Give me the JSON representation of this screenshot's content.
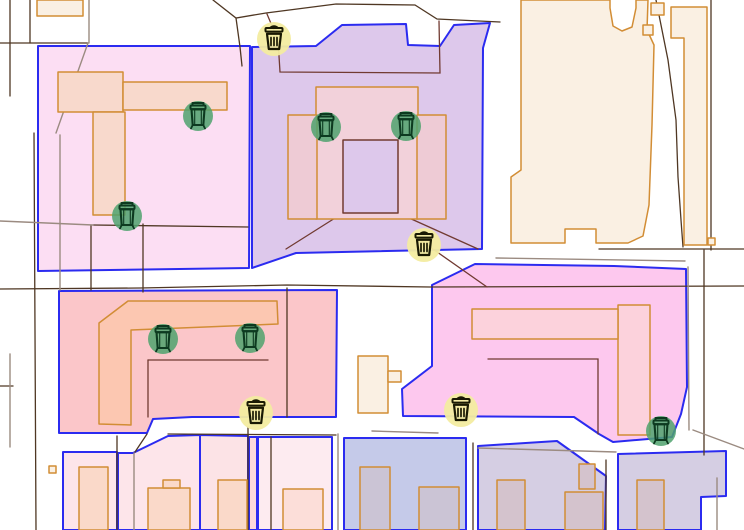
{
  "canvas": {
    "width": 744,
    "height": 530,
    "background": "#ffffff"
  },
  "palette": {
    "zone_border": "#2b2bf0",
    "building_stroke": "#d28d35",
    "line_dark": "#4f3723",
    "line_gray": "#9b8b81",
    "line_maroon": "#713a31",
    "marker_basket_bg": "#f3eca0",
    "marker_basket_glyph": "#191903",
    "marker_disposal_bg": "#4fa26d",
    "marker_disposal_glyph": "#0d3a20"
  },
  "map": {
    "zones": [
      {
        "name": "zone-pink-top-left",
        "fill": "#fcdef3",
        "points": "38,46 250,46 249,268 38,271"
      },
      {
        "name": "zone-purple-top-center",
        "fill": "#ddc8eb",
        "points": "252,47 316,46 342,25 406,24 408,45 440,46 454,25 490,23 483,48 482,249 296,253 252,268"
      },
      {
        "name": "zone-salmon-middle-left",
        "fill": "#fbc6c9",
        "points": "59,291 337,290 336,417 192,417 153,419 147,433 59,433"
      },
      {
        "name": "zone-pink-middle-right",
        "fill": "#fdc8ee",
        "points": "432,285 475,264 614,266 686,269 687,387 681,414 672,437 613,442 599,434 574,417 403,416 402,389 432,366"
      },
      {
        "name": "zone-periwinkle-bottom",
        "fill": "#c5cae9",
        "points": "344,438 466,438 466,530 344,530"
      },
      {
        "name": "zone-mauve-bottom-1",
        "fill": "#d5cee3",
        "points": "478,446 557,441 606,476 605,530 478,530"
      },
      {
        "name": "zone-mauve-bottom-2",
        "fill": "#d5cee3",
        "points": "618,454 726,451 726,496 701,497 701,530 618,530"
      },
      {
        "name": "zone-parcel-p1",
        "fill": "#fde5ea",
        "points": "63,452 117,452 117,530 63,530"
      },
      {
        "name": "zone-parcel-p2",
        "fill": "#fde5ea",
        "points": "118,453 133,453 168,436 200,435 200,530 118,530"
      },
      {
        "name": "zone-parcel-p3",
        "fill": "#fce3e6",
        "points": "200,435 248,436 248,530 200,530"
      },
      {
        "name": "zone-parcel-p4",
        "fill": "#fbd8dc",
        "points": "249,437 257,437 257,530 249,530"
      },
      {
        "name": "zone-parcel-p5",
        "fill": "#fdebf0",
        "points": "258,437 332,437 332,530 258,530"
      }
    ],
    "parcel_lines": [
      {
        "color": "dark",
        "points": "10,0 10,96"
      },
      {
        "color": "dark",
        "points": "30,0 30,43"
      },
      {
        "color": "dark",
        "points": "0,43 88,43"
      },
      {
        "color": "dark",
        "points": "34,133 36,530"
      },
      {
        "color": "dark",
        "points": "213,0 236,18 266,13 336,4 415,5 437,19 500,22"
      },
      {
        "color": "dark",
        "points": "236,18 240,47 242,66"
      },
      {
        "color": "dark",
        "points": "0,289 140,288 287,285 430,287 744,286"
      },
      {
        "color": "dark",
        "points": "91,225 91,290"
      },
      {
        "color": "dark",
        "points": "143,224 143,292"
      },
      {
        "color": "dark",
        "points": "93,225 248,227"
      },
      {
        "color": "dark",
        "points": "287,288 287,417"
      },
      {
        "color": "dark",
        "points": "599,249 744,249"
      },
      {
        "color": "dark",
        "points": "704,250 704,455"
      },
      {
        "color": "dark",
        "points": "711,0 711,250"
      },
      {
        "color": "dark",
        "points": "656,0 668,60 676,120 678,177 681,220 683,247"
      },
      {
        "color": "dark",
        "points": "117,436 117,530"
      },
      {
        "color": "dark",
        "points": "248,427 248,530"
      },
      {
        "color": "dark",
        "points": "271,437 271,530"
      },
      {
        "color": "dark",
        "points": "473,443 473,530"
      },
      {
        "color": "dark",
        "points": "606,460 606,530"
      },
      {
        "color": "dark",
        "points": "168,434 336,435"
      },
      {
        "color": "dark",
        "points": "147,434 135,452"
      },
      {
        "color": "dark",
        "points": "0,386 13,386"
      },
      {
        "color": "gray",
        "points": "89,0 89,43"
      },
      {
        "color": "gray",
        "points": "88,43 56,133"
      },
      {
        "color": "gray",
        "points": "60,135 60,290"
      },
      {
        "color": "gray",
        "points": "0,221 93,225"
      },
      {
        "color": "gray",
        "points": "496,258 685,261"
      },
      {
        "color": "gray",
        "points": "688,267 689,430"
      },
      {
        "color": "gray",
        "points": "693,430 744,449"
      },
      {
        "color": "gray",
        "points": "717,478 717,530"
      },
      {
        "color": "gray",
        "points": "134,453 134,530"
      },
      {
        "color": "gray",
        "points": "338,434 338,530"
      },
      {
        "color": "gray",
        "points": "372,431 438,433"
      },
      {
        "color": "gray",
        "points": "478,448 616,452"
      },
      {
        "color": "gray",
        "points": "10,354 10,447"
      },
      {
        "color": "maroon",
        "points": "267,14 278,40 280,72 440,73 439,21"
      },
      {
        "color": "maroon",
        "points": "343,213 286,249"
      },
      {
        "color": "maroon",
        "points": "398,213 478,249"
      },
      {
        "color": "maroon",
        "points": "148,360 268,360"
      },
      {
        "color": "maroon",
        "points": "148,360 148,417"
      },
      {
        "color": "maroon",
        "points": "488,359 598,359 598,434"
      },
      {
        "color": "maroon",
        "points": "420,240 487,287"
      }
    ],
    "buildings": [
      {
        "name": "building",
        "fill": "#faf0e3",
        "points": "37,0 83,0 83,16 37,16"
      },
      {
        "name": "building",
        "fill": "#faf0e3",
        "points": "521,0 610,0 610,8 613,26 622,31 632,27 636,8 636,0 648,0 647,30 654,45 652,125 649,205 643,236 628,243 596,243 596,229 565,229 565,243 511,243 511,177 521,170"
      },
      {
        "name": "building",
        "fill": "#faf0e3",
        "points": "651,3 664,3 664,15 651,15"
      },
      {
        "name": "building",
        "fill": "#faf0e3",
        "points": "643,25 653,25 653,35 643,35"
      },
      {
        "name": "building",
        "fill": "#faf0e3",
        "points": "708,238 715,238 715,245 708,245"
      },
      {
        "name": "building",
        "fill": "#faf0e3",
        "points": "671,7 707,7 707,245 684,245 684,38 671,38"
      },
      {
        "name": "building",
        "fill": "#faf0e3",
        "points": "358,356 388,356 388,413 358,413"
      },
      {
        "name": "building",
        "fill": "#faf0e3",
        "points": "388,371 401,371 401,382 388,382"
      },
      {
        "name": "building",
        "fill": "#faf0e3",
        "points": "49,466 56,466 56,473 49,473"
      },
      {
        "name": "building",
        "fill": "#f8d9cc",
        "points": "58,72 123,72 123,112 58,112"
      },
      {
        "name": "building",
        "fill": "#f8d9cc",
        "points": "123,82 227,82 227,110 123,110"
      },
      {
        "name": "building",
        "fill": "#f8d9cc",
        "points": "93,112 125,112 125,215 93,215"
      },
      {
        "name": "building",
        "fill": "#f2d1da",
        "points": "316,87 418,87 418,219 316,219"
      },
      {
        "name": "building",
        "fill": "#eecbd5",
        "points": "288,115 317,115 317,219 288,219"
      },
      {
        "name": "building",
        "fill": "#eecbd5",
        "points": "417,115 446,115 446,219 417,219"
      },
      {
        "name": "building-courtyard",
        "fill": "#ddc8eb",
        "stroke": "maroon",
        "points": "343,140 398,140 398,213 343,213"
      },
      {
        "name": "building",
        "fill": "#fcc7b1",
        "points": "128,301 277,301 278,324 131,330 131,425 99,424 99,323"
      },
      {
        "name": "building",
        "fill": "#fcd2dc",
        "points": "618,305 650,305 650,435 618,435"
      },
      {
        "name": "building",
        "fill": "#fcd2dc",
        "points": "472,309 618,309 618,339 472,339"
      },
      {
        "name": "building",
        "fill": "#cbc4d5",
        "points": "360,467 390,467 390,530 360,530"
      },
      {
        "name": "building",
        "fill": "#cbc4d5",
        "points": "419,487 459,487 459,530 419,530"
      },
      {
        "name": "building",
        "fill": "#d4c3cd",
        "points": "497,480 525,480 525,530 497,530"
      },
      {
        "name": "building",
        "fill": "#d4c3cd",
        "points": "565,492 603,492 603,530 565,530"
      },
      {
        "name": "building",
        "fill": "#d4c3cd",
        "points": "579,464 595,464 595,489 579,489"
      },
      {
        "name": "building",
        "fill": "#d4c3cd",
        "points": "637,480 664,480 664,530 637,530"
      },
      {
        "name": "building",
        "fill": "#fad9c9",
        "points": "79,467 108,467 108,530 79,530"
      },
      {
        "name": "building",
        "fill": "#fad9c9",
        "points": "148,488 190,488 190,530 148,530"
      },
      {
        "name": "building",
        "fill": "#fad9c9",
        "points": "163,480 180,480 180,488 163,488"
      },
      {
        "name": "building",
        "fill": "#fad9c9",
        "points": "218,480 247,480 247,530 218,530"
      },
      {
        "name": "building",
        "fill": "#fcded9",
        "points": "283,489 323,489 323,530 283,530"
      }
    ],
    "markers": [
      {
        "type": "waste-basket",
        "x": 274,
        "y": 39
      },
      {
        "type": "waste-basket",
        "x": 424,
        "y": 245
      },
      {
        "type": "waste-basket",
        "x": 256,
        "y": 413
      },
      {
        "type": "waste-basket",
        "x": 461,
        "y": 410
      },
      {
        "type": "waste-disposal",
        "x": 198,
        "y": 116
      },
      {
        "type": "waste-disposal",
        "x": 127,
        "y": 216
      },
      {
        "type": "waste-disposal",
        "x": 326,
        "y": 127
      },
      {
        "type": "waste-disposal",
        "x": 406,
        "y": 126
      },
      {
        "type": "waste-disposal",
        "x": 163,
        "y": 339
      },
      {
        "type": "waste-disposal",
        "x": 250,
        "y": 338
      },
      {
        "type": "waste-disposal",
        "x": 661,
        "y": 431
      }
    ]
  }
}
